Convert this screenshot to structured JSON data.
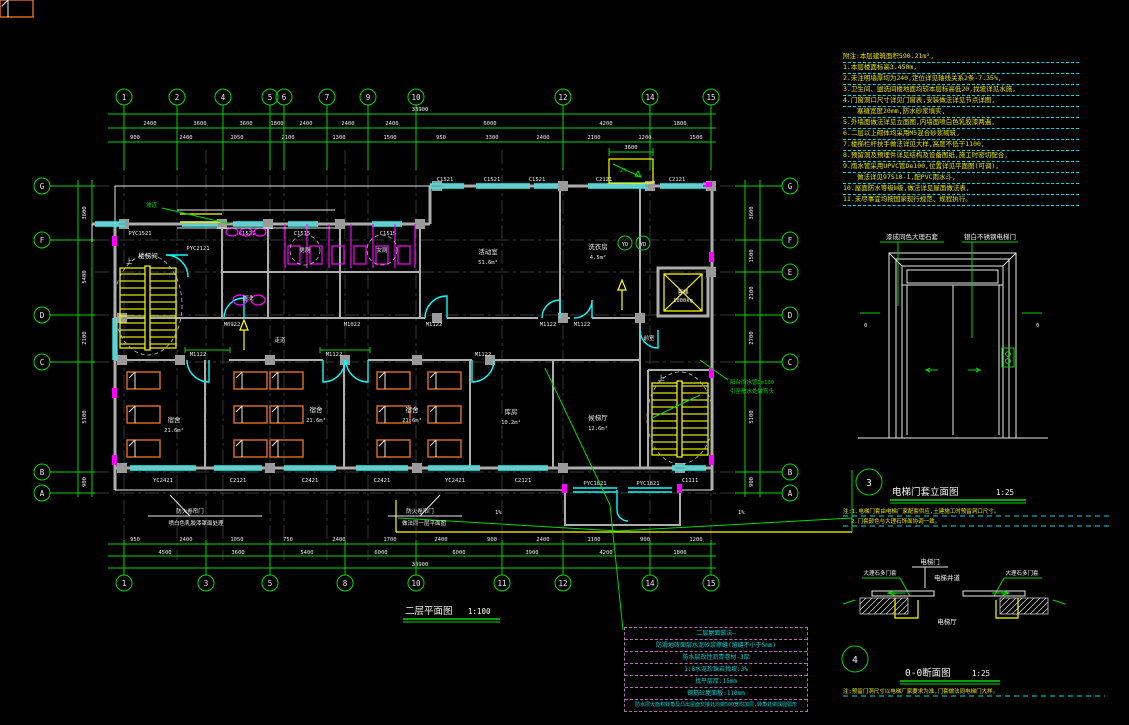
{
  "colors": {
    "green": "#00d900",
    "cyan": "#00ffff",
    "yellow": "#ffff00",
    "magenta": "#ff00ff",
    "orange": "#d2691e",
    "wall_gray": "#adadad",
    "purple": "#b469b4",
    "table_cyan": "#00d2d2"
  },
  "grid": {
    "top": [
      "1",
      "2",
      "4",
      "5",
      "6",
      "7",
      "9",
      "10",
      "12",
      "14",
      "15"
    ],
    "bottom": [
      "1",
      "3",
      "5",
      "8",
      "10",
      "11",
      "12",
      "14",
      "15"
    ],
    "left": [
      "G",
      "F",
      "D",
      "C",
      "B",
      "A"
    ],
    "right": [
      "G",
      "F",
      "E",
      "D",
      "C",
      "B",
      "A"
    ]
  },
  "dims": {
    "top_total": "33900",
    "bottom_total": "33900",
    "top_row": [
      "2400",
      "3600",
      "3600",
      "1800",
      "2400",
      "2400",
      "2400",
      "6000",
      "4200",
      "1800"
    ],
    "top_small": [
      "900",
      "2400",
      "1050",
      "2100",
      "1300",
      "1500",
      "950",
      "3300",
      "2400",
      "2100",
      "1200",
      "1500"
    ],
    "bottom_row": [
      "4500",
      "3600",
      "5400",
      "6000",
      "6000",
      "3900",
      "4200",
      "1800"
    ],
    "bottom_small": [
      "950",
      "2400",
      "1050",
      "750",
      "2400",
      "1700",
      "2400",
      "900",
      "2400",
      "1100",
      "900",
      "1200"
    ],
    "left_col": [
      "3600",
      "5400",
      "2100",
      "5100",
      "900"
    ],
    "right_col": [
      "3600",
      "1500",
      "2100",
      "2700",
      "5100",
      "900"
    ],
    "canopy": "3600",
    "canopy_slope": "2%",
    "slope_left": "1%",
    "slope_right": "1%"
  },
  "windows": {
    "top": [
      "PYC1521",
      "PYC2121",
      "C1521",
      "C1515",
      "C1515",
      "C1521",
      "C1521",
      "C1521",
      "C2121",
      "C2121"
    ],
    "bottom": [
      "YC2421",
      "C2121",
      "C2421",
      "C2421",
      "YC2421",
      "C2121",
      "PYC1821",
      "PYC1821",
      "C1111"
    ]
  },
  "doors": {
    "m0922": "M0922",
    "m1022": "M1022",
    "m1122": "M1122"
  },
  "rooms": {
    "stair": "楼梯间",
    "up": "上",
    "wc_m": "男厕",
    "wc_f": "女厕",
    "wash": "盥洗",
    "corridor": "走道",
    "activity": "活动室",
    "activity_area": "51.6m²",
    "laundry": "洗衣房",
    "laundry_area": "4.5m²",
    "front": "前室",
    "dorm": "宿舍",
    "dorm_area": "21.6m²",
    "store": "库房",
    "store_area": "10.2m²",
    "hall": "候梯厅",
    "hall_area": "12.6m²",
    "elevator": "客梯",
    "elevator_load": "1000kg",
    "yd": "YD",
    "ramp": "坡道"
  },
  "plan_notes": {
    "rolldoor1a": "防火卷帘门",
    "rolldoor1b": "喷白色乳胶漆罩面处理",
    "rolldoor2a": "防火卷帘门",
    "rolldoor2b": "做法同一层平面图",
    "rain1": "阳台雨水管De100",
    "rain2": "引至散水处做弯头"
  },
  "title": {
    "main": "二层平面图",
    "main_scale": "1:100"
  },
  "notes_list": [
    "附注:本层建筑面积590.21m²,",
    "1.本层楼面标高3.450m,",
    "2.未注明墙厚均为240,定位详见轴线关系2条-7.35%,",
    "3.卫生间、盥洗间楼地面均较本层标高低20,找坡详见水施,",
    "4.门窗洞口尺寸详见门窗表,安装做法详见节点详图,",
    "塞缝宽度20mm,防水砂浆填实,",
    "5.外墙面做法详见立面图,内墙面喷白色乳胶漆两遍,",
    "6.二层以上砌体均采用M5混合砂浆砌筑,",
    "7.楼梯栏杆扶手做法详见大样,高度不低于1100,",
    "8.预留洞及预埋件详见结构及设备图纸,施工时密切配合,",
    "9.雨水管采用UPVC管De100,位置详见平面图(可调),",
    "做法详见97S10-1,配PVC雨水斗,",
    "10.屋面防水等级Ⅱ级,做法详见屋面做法表,",
    "11.未尽事宜均按国家现行规范、规程执行。"
  ],
  "detail3": {
    "no": "3",
    "title": "电梯门套立面图",
    "scale": "1:25",
    "label_left": "漆成同色大理石套",
    "label_right": "银白不锈钢电梯门",
    "zero_left": "0",
    "zero_right": "0",
    "note1": "注:1.电梯门套由电梯厂家配套供应,土建施工时预留洞口尺寸。",
    "note2": "2.门套颜色与大理石饰面协调一致。"
  },
  "detail4": {
    "no": "4",
    "title": "0-0断面图",
    "scale": "1:25",
    "door": "电梯门",
    "shaft": "电梯井道",
    "jamb_left": "大理石多门套",
    "jamb_right": "大理石多门套",
    "hall": "电梯厅",
    "note": "注:预留门洞尺寸以电梯厂家要求为准,门套做法同电梯门大样。"
  },
  "rooftable": {
    "r0": "二层屋面做法—",
    "r1": "防滑地砖面层水泥砂浆擦缝(留缝不小于5mm)",
    "r2": "防水层改性沥青卷材-3厚",
    "r3": "1:8水泥珍珠岩找坡:3%",
    "r4": "找平层厚:15mm",
    "r5": "钢筋砼屋面板:110mm",
    "r6": "防水层大面积转角及凸出屋面交接处均做500宽附加层,转角处做成圆弧形"
  }
}
